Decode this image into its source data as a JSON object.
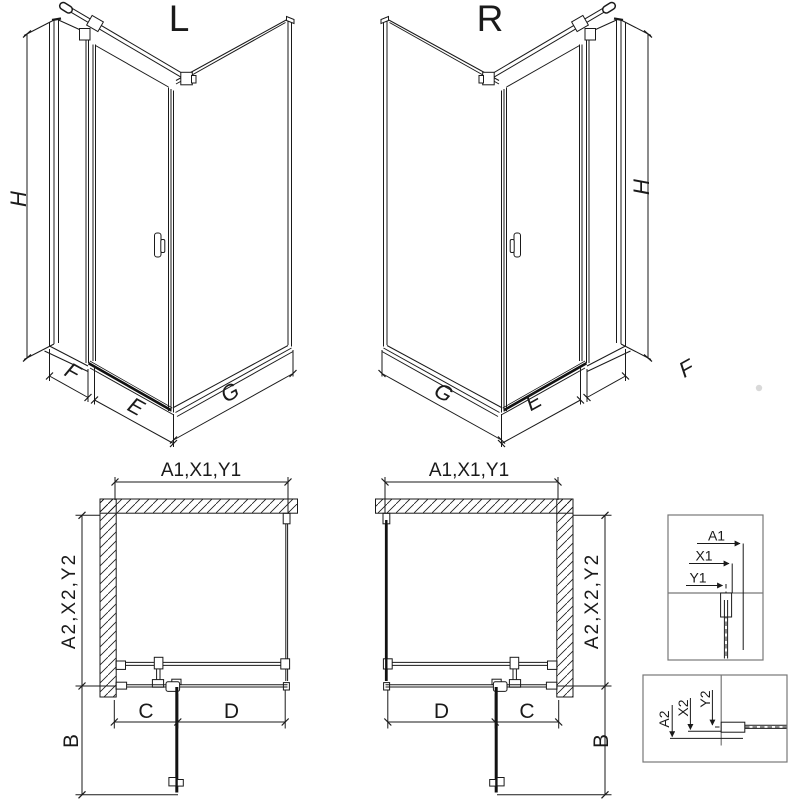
{
  "iso_left": {
    "label": "L",
    "dim_h": "H",
    "dim_f": "F",
    "dim_e": "E",
    "dim_g": "G"
  },
  "iso_right": {
    "label": "R",
    "dim_h": "H",
    "dim_f": "F",
    "dim_e": "E",
    "dim_g": "G"
  },
  "plan_left": {
    "top_dim": "A1,X1,Y1",
    "side_dim": "A2,X2,Y2",
    "swing_dim": "B",
    "dim_c": "C",
    "dim_d": "D"
  },
  "plan_right": {
    "top_dim": "A1,X1,Y1",
    "side_dim": "A2,X2,Y2",
    "swing_dim": "B",
    "dim_c": "C",
    "dim_d": "D"
  },
  "detail_horizontal": {
    "labels": [
      "A1",
      "X1",
      "Y1"
    ]
  },
  "detail_vertical": {
    "labels": [
      "A2",
      "X2",
      "Y2"
    ]
  },
  "colors": {
    "line": "#1a1a1a",
    "paper": "#ffffff",
    "watermark_dot": "#d9d9d9"
  }
}
